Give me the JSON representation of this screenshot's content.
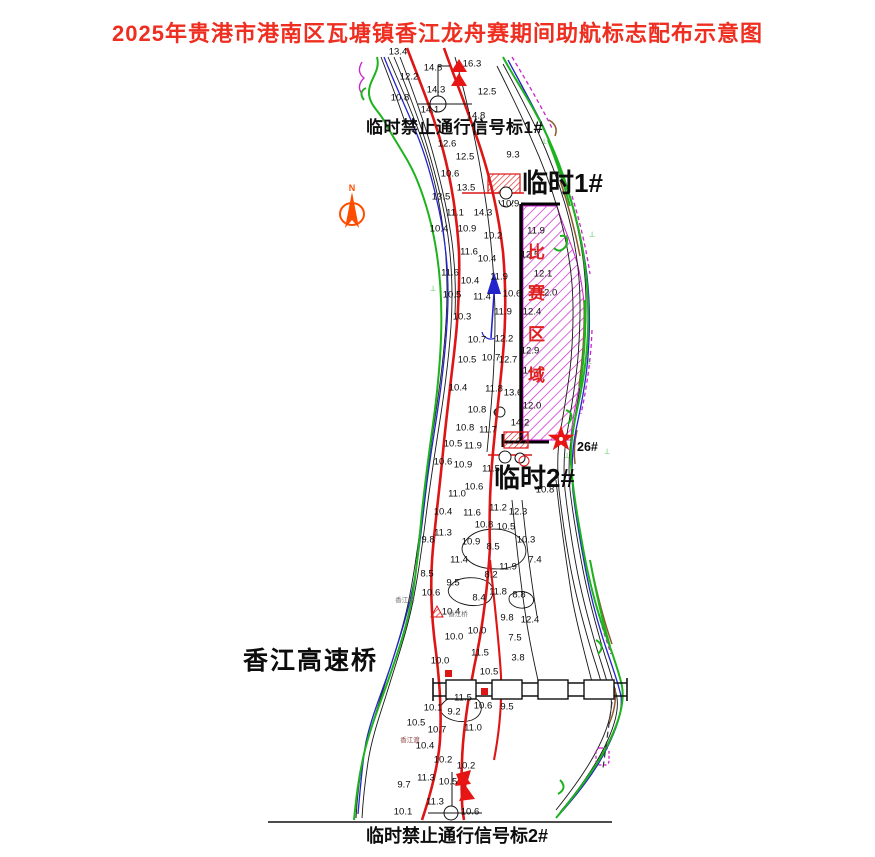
{
  "title": {
    "text": "2025年贵港市港南区瓦塘镇香江龙舟赛期间助航标志配布示意图",
    "color": "#ee2e20"
  },
  "annotations": {
    "no_pass_1": "临时禁止通行信号标1#",
    "temp_1": "临时1#",
    "temp_2": "临时2#",
    "mark_26": "26#",
    "bridge": "香江高速桥",
    "no_pass_2": "临时禁止通行信号标2#",
    "race_area": "比赛区域",
    "north": "N"
  },
  "tiny_labels": [
    {
      "text": "香江桥",
      "x": 405,
      "y": 601,
      "c": "#6a6a6a"
    },
    {
      "text": "香江桥",
      "x": 458,
      "y": 615,
      "c": "#6a6a6a"
    },
    {
      "text": "香江渡",
      "x": 410,
      "y": 741,
      "c": "#8a4040"
    }
  ],
  "veg_marks": [
    {
      "x": 433,
      "y": 289
    },
    {
      "x": 592,
      "y": 235
    },
    {
      "x": 589,
      "y": 362
    },
    {
      "x": 567,
      "y": 456
    },
    {
      "x": 607,
      "y": 452
    },
    {
      "x": 544,
      "y": 142
    }
  ],
  "symbols": {
    "north_arrow": "orange compass arrow with N",
    "signal_mark": "red double triangle no-passage signal",
    "temporary_mark": "red hatched box buoy",
    "race_boundary": "magenta hatched rectangle with black border",
    "star_mark_26": "red five-point star",
    "flow_arrow": "blue upstream arrow"
  },
  "colors": {
    "title_red": "#ee2e20",
    "bank_green": "#1db31d",
    "water_blue": "#2424cc",
    "channel_red": "#dd1515",
    "hatch_magenta": "#cc22cc",
    "race_red": "#e02020",
    "brown": "#8a5a2b",
    "mark_red": "#e81515"
  },
  "depths": [
    {
      "x": 398,
      "y": 52,
      "v": "13.4"
    },
    {
      "x": 433,
      "y": 68,
      "v": "14.8"
    },
    {
      "x": 472,
      "y": 64,
      "v": "16.3"
    },
    {
      "x": 409,
      "y": 77,
      "v": "12.2"
    },
    {
      "x": 436,
      "y": 90,
      "v": "14.3"
    },
    {
      "x": 487,
      "y": 92,
      "v": "12.5"
    },
    {
      "x": 400,
      "y": 98,
      "v": "10.8"
    },
    {
      "x": 430,
      "y": 110,
      "v": "14.1"
    },
    {
      "x": 476,
      "y": 116,
      "v": "14.8"
    },
    {
      "x": 447,
      "y": 144,
      "v": "12.6"
    },
    {
      "x": 465,
      "y": 157,
      "v": "12.5"
    },
    {
      "x": 513,
      "y": 155,
      "v": "9.3"
    },
    {
      "x": 450,
      "y": 174,
      "v": "10.6"
    },
    {
      "x": 466,
      "y": 188,
      "v": "13.5"
    },
    {
      "x": 441,
      "y": 197,
      "v": "13.5"
    },
    {
      "x": 510,
      "y": 204,
      "v": "10.9"
    },
    {
      "x": 455,
      "y": 213,
      "v": "11.1"
    },
    {
      "x": 483,
      "y": 213,
      "v": "14.3"
    },
    {
      "x": 439,
      "y": 229,
      "v": "10.4"
    },
    {
      "x": 467,
      "y": 229,
      "v": "10.9"
    },
    {
      "x": 493,
      "y": 236,
      "v": "10.2"
    },
    {
      "x": 469,
      "y": 252,
      "v": "11.6"
    },
    {
      "x": 487,
      "y": 259,
      "v": "10.4"
    },
    {
      "x": 536,
      "y": 231,
      "v": "11.9"
    },
    {
      "x": 530,
      "y": 255,
      "v": "12.5"
    },
    {
      "x": 543,
      "y": 274,
      "v": "12.1"
    },
    {
      "x": 548,
      "y": 293,
      "v": "12.0"
    },
    {
      "x": 532,
      "y": 312,
      "v": "12.4"
    },
    {
      "x": 503,
      "y": 312,
      "v": "11.9"
    },
    {
      "x": 450,
      "y": 273,
      "v": "11.6"
    },
    {
      "x": 499,
      "y": 277,
      "v": "11.9"
    },
    {
      "x": 470,
      "y": 281,
      "v": "10.4"
    },
    {
      "x": 452,
      "y": 295,
      "v": "10.5"
    },
    {
      "x": 482,
      "y": 297,
      "v": "11.4"
    },
    {
      "x": 512,
      "y": 294,
      "v": "10.6"
    },
    {
      "x": 462,
      "y": 317,
      "v": "10.3"
    },
    {
      "x": 477,
      "y": 340,
      "v": "10.7"
    },
    {
      "x": 504,
      "y": 339,
      "v": "12.2"
    },
    {
      "x": 467,
      "y": 360,
      "v": "10.5"
    },
    {
      "x": 491,
      "y": 358,
      "v": "10.7"
    },
    {
      "x": 508,
      "y": 360,
      "v": "12.7"
    },
    {
      "x": 530,
      "y": 351,
      "v": "12.9"
    },
    {
      "x": 532,
      "y": 371,
      "v": "14.4"
    },
    {
      "x": 494,
      "y": 389,
      "v": "11.8"
    },
    {
      "x": 513,
      "y": 393,
      "v": "13.6"
    },
    {
      "x": 532,
      "y": 406,
      "v": "12.0"
    },
    {
      "x": 520,
      "y": 423,
      "v": "14.2"
    },
    {
      "x": 488,
      "y": 430,
      "v": "11.7"
    },
    {
      "x": 458,
      "y": 388,
      "v": "10.4"
    },
    {
      "x": 477,
      "y": 410,
      "v": "10.8"
    },
    {
      "x": 465,
      "y": 428,
      "v": "10.8"
    },
    {
      "x": 453,
      "y": 444,
      "v": "10.5"
    },
    {
      "x": 473,
      "y": 446,
      "v": "11.9"
    },
    {
      "x": 443,
      "y": 462,
      "v": "10.6"
    },
    {
      "x": 463,
      "y": 465,
      "v": "10.9"
    },
    {
      "x": 491,
      "y": 469,
      "v": "11.5"
    },
    {
      "x": 474,
      "y": 487,
      "v": "10.6"
    },
    {
      "x": 545,
      "y": 490,
      "v": "10.8"
    },
    {
      "x": 457,
      "y": 494,
      "v": "11.0"
    },
    {
      "x": 443,
      "y": 512,
      "v": "10.4"
    },
    {
      "x": 472,
      "y": 513,
      "v": "11.6"
    },
    {
      "x": 498,
      "y": 508,
      "v": "11.2"
    },
    {
      "x": 518,
      "y": 512,
      "v": "12.3"
    },
    {
      "x": 484,
      "y": 525,
      "v": "10.8"
    },
    {
      "x": 506,
      "y": 527,
      "v": "10.5"
    },
    {
      "x": 443,
      "y": 533,
      "v": "11.3"
    },
    {
      "x": 526,
      "y": 540,
      "v": "10.3"
    },
    {
      "x": 471,
      "y": 542,
      "v": "10.9"
    },
    {
      "x": 493,
      "y": 547,
      "v": "8.5"
    },
    {
      "x": 428,
      "y": 540,
      "v": "9.8"
    },
    {
      "x": 459,
      "y": 560,
      "v": "11.4"
    },
    {
      "x": 508,
      "y": 567,
      "v": "11.9"
    },
    {
      "x": 535,
      "y": 560,
      "v": "7.4"
    },
    {
      "x": 491,
      "y": 575,
      "v": "8.2"
    },
    {
      "x": 453,
      "y": 583,
      "v": "9.5"
    },
    {
      "x": 427,
      "y": 574,
      "v": "8.5"
    },
    {
      "x": 479,
      "y": 598,
      "v": "8.4"
    },
    {
      "x": 498,
      "y": 592,
      "v": "11.8"
    },
    {
      "x": 519,
      "y": 595,
      "v": "8.8"
    },
    {
      "x": 431,
      "y": 593,
      "v": "10.6"
    },
    {
      "x": 451,
      "y": 612,
      "v": "10.4"
    },
    {
      "x": 507,
      "y": 618,
      "v": "9.8"
    },
    {
      "x": 530,
      "y": 620,
      "v": "12.4"
    },
    {
      "x": 454,
      "y": 637,
      "v": "10.0"
    },
    {
      "x": 477,
      "y": 631,
      "v": "10.0"
    },
    {
      "x": 515,
      "y": 638,
      "v": "7.5"
    },
    {
      "x": 480,
      "y": 653,
      "v": "11.5"
    },
    {
      "x": 440,
      "y": 661,
      "v": "10.0"
    },
    {
      "x": 489,
      "y": 672,
      "v": "10.5"
    },
    {
      "x": 518,
      "y": 658,
      "v": "3.8"
    },
    {
      "x": 463,
      "y": 698,
      "v": "11.5"
    },
    {
      "x": 433,
      "y": 708,
      "v": "10.1"
    },
    {
      "x": 483,
      "y": 706,
      "v": "10.6"
    },
    {
      "x": 454,
      "y": 712,
      "v": "9.2"
    },
    {
      "x": 507,
      "y": 707,
      "v": "9.5"
    },
    {
      "x": 416,
      "y": 723,
      "v": "10.5"
    },
    {
      "x": 437,
      "y": 730,
      "v": "10.7"
    },
    {
      "x": 473,
      "y": 728,
      "v": "11.0"
    },
    {
      "x": 425,
      "y": 746,
      "v": "10.4"
    },
    {
      "x": 443,
      "y": 760,
      "v": "10.2"
    },
    {
      "x": 466,
      "y": 766,
      "v": "10.2"
    },
    {
      "x": 426,
      "y": 778,
      "v": "11.3"
    },
    {
      "x": 448,
      "y": 782,
      "v": "10.5"
    },
    {
      "x": 404,
      "y": 785,
      "v": "9.7"
    },
    {
      "x": 435,
      "y": 802,
      "v": "11.3"
    },
    {
      "x": 403,
      "y": 812,
      "v": "10.1"
    },
    {
      "x": 470,
      "y": 812,
      "v": "10.6"
    }
  ]
}
